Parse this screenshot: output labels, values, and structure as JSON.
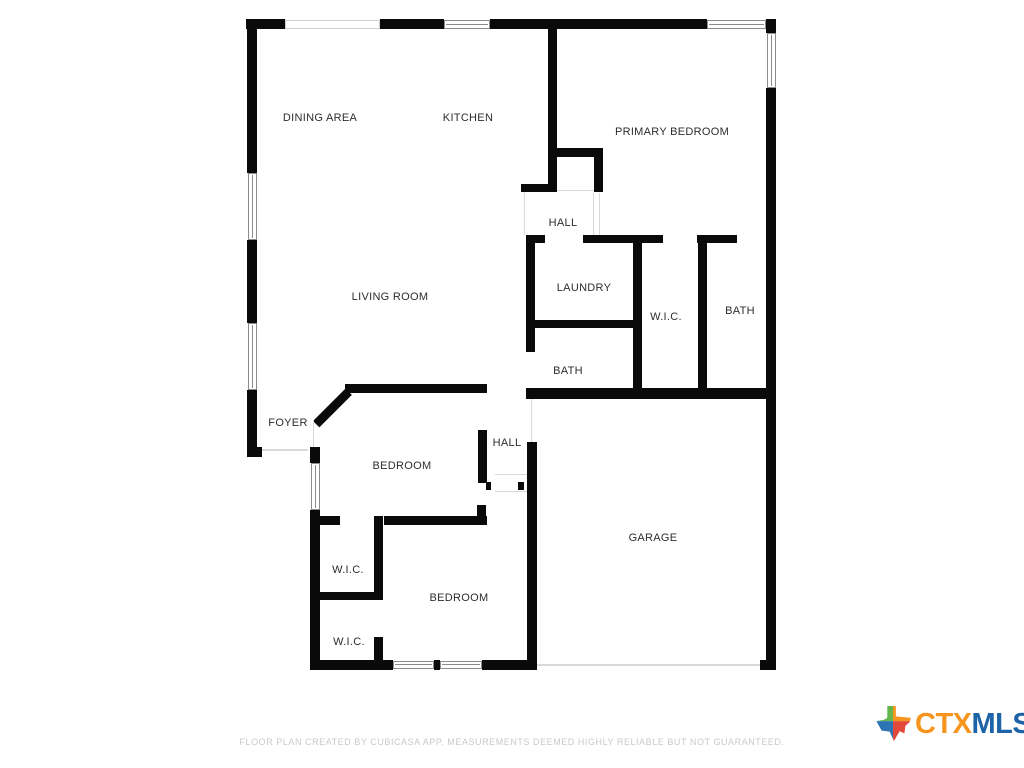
{
  "disclaimer": "FLOOR PLAN CREATED BY CUBICASA APP. MEASUREMENTS DEEMED HIGHLY RELIABLE BUT NOT GUARANTEED.",
  "logo": {
    "ctx": "CTX",
    "mls": "MLS",
    "ctx_color": "#F7941E",
    "mls_color": "#1C63A7",
    "texas_colors": {
      "green": "#64B54C",
      "orange": "#F7941E",
      "blue": "#2D74B5",
      "red": "#E2493B"
    }
  },
  "floorplan": {
    "wall_color": "#0a0a0a",
    "window_border": "#8c8c8c",
    "opening_color": "#d9d9d9",
    "label_color": "#2d2d2d",
    "labels": [
      {
        "id": "dining-area",
        "text": "DINING AREA",
        "x": 320,
        "y": 118
      },
      {
        "id": "kitchen",
        "text": "KITCHEN",
        "x": 468,
        "y": 118
      },
      {
        "id": "primary-bedroom",
        "text": "PRIMARY BEDROOM",
        "x": 672,
        "y": 132
      },
      {
        "id": "hall-upper",
        "text": "HALL",
        "x": 563,
        "y": 223
      },
      {
        "id": "living-room",
        "text": "LIVING ROOM",
        "x": 390,
        "y": 297
      },
      {
        "id": "laundry",
        "text": "LAUNDRY",
        "x": 584,
        "y": 288
      },
      {
        "id": "wic-primary",
        "text": "W.I.C.",
        "x": 666,
        "y": 317
      },
      {
        "id": "bath-primary",
        "text": "BATH",
        "x": 740,
        "y": 311
      },
      {
        "id": "bath-main",
        "text": "BATH",
        "x": 568,
        "y": 371
      },
      {
        "id": "foyer",
        "text": "FOYER",
        "x": 288,
        "y": 423
      },
      {
        "id": "bedroom-front",
        "text": "BEDROOM",
        "x": 402,
        "y": 466
      },
      {
        "id": "hall-lower",
        "text": "HALL",
        "x": 507,
        "y": 443
      },
      {
        "id": "wic-1",
        "text": "W.I.C.",
        "x": 348,
        "y": 570
      },
      {
        "id": "bedroom-lower",
        "text": "BEDROOM",
        "x": 459,
        "y": 598
      },
      {
        "id": "wic-2",
        "text": "W.I.C.",
        "x": 349,
        "y": 642
      },
      {
        "id": "garage",
        "text": "GARAGE",
        "x": 653,
        "y": 538
      }
    ],
    "walls": [
      {
        "x": 246,
        "y": 19,
        "w": 39,
        "h": 10
      },
      {
        "x": 380,
        "y": 19,
        "w": 64,
        "h": 10
      },
      {
        "x": 490,
        "y": 19,
        "w": 217,
        "h": 10
      },
      {
        "x": 766,
        "y": 19,
        "w": 10,
        "h": 14
      },
      {
        "x": 766,
        "y": 88,
        "w": 10,
        "h": 582
      },
      {
        "x": 247,
        "y": 19,
        "w": 10,
        "h": 154
      },
      {
        "x": 247,
        "y": 240,
        "w": 10,
        "h": 83
      },
      {
        "x": 247,
        "y": 390,
        "w": 10,
        "h": 57
      },
      {
        "x": 247,
        "y": 447,
        "w": 15,
        "h": 10
      },
      {
        "x": 548,
        "y": 29,
        "w": 9,
        "h": 163
      },
      {
        "x": 557,
        "y": 148,
        "w": 46,
        "h": 9
      },
      {
        "x": 594,
        "y": 148,
        "w": 9,
        "h": 44
      },
      {
        "x": 521,
        "y": 184,
        "w": 36,
        "h": 8
      },
      {
        "x": 526,
        "y": 235,
        "w": 19,
        "h": 8
      },
      {
        "x": 583,
        "y": 235,
        "w": 80,
        "h": 8
      },
      {
        "x": 697,
        "y": 235,
        "w": 40,
        "h": 8
      },
      {
        "x": 526,
        "y": 243,
        "w": 9,
        "h": 109
      },
      {
        "x": 633,
        "y": 235,
        "w": 9,
        "h": 163
      },
      {
        "x": 698,
        "y": 235,
        "w": 9,
        "h": 163
      },
      {
        "x": 526,
        "y": 320,
        "w": 116,
        "h": 8
      },
      {
        "x": 526,
        "y": 388,
        "w": 250,
        "h": 11
      },
      {
        "x": 527,
        "y": 442,
        "w": 10,
        "h": 228
      },
      {
        "x": 760,
        "y": 660,
        "w": 16,
        "h": 10
      },
      {
        "x": 345,
        "y": 384,
        "w": 142,
        "h": 9
      },
      {
        "x": 478,
        "y": 430,
        "w": 9,
        "h": 53
      },
      {
        "x": 477,
        "y": 505,
        "w": 9,
        "h": 20
      },
      {
        "x": 486,
        "y": 482,
        "w": 5,
        "h": 8
      },
      {
        "x": 518,
        "y": 482,
        "w": 6,
        "h": 8
      },
      {
        "x": 310,
        "y": 516,
        "w": 30,
        "h": 9
      },
      {
        "x": 384,
        "y": 516,
        "w": 103,
        "h": 9
      },
      {
        "x": 310,
        "y": 447,
        "w": 10,
        "h": 16
      },
      {
        "x": 310,
        "y": 510,
        "w": 10,
        "h": 158
      },
      {
        "x": 374,
        "y": 516,
        "w": 9,
        "h": 84
      },
      {
        "x": 374,
        "y": 637,
        "w": 9,
        "h": 31
      },
      {
        "x": 310,
        "y": 592,
        "w": 73,
        "h": 8
      },
      {
        "x": 310,
        "y": 660,
        "w": 83,
        "h": 10
      },
      {
        "x": 434,
        "y": 660,
        "w": 6,
        "h": 10
      },
      {
        "x": 482,
        "y": 660,
        "w": 55,
        "h": 10
      }
    ],
    "diagonals": [
      {
        "x": 313,
        "y": 421,
        "len": 46,
        "thick": 9,
        "angle": -45
      }
    ],
    "windows": [
      {
        "x": 285,
        "y": 20,
        "w": 95,
        "h": 9,
        "variant": "light"
      },
      {
        "x": 444,
        "y": 20,
        "w": 46,
        "h": 9
      },
      {
        "x": 707,
        "y": 20,
        "w": 59,
        "h": 9
      },
      {
        "x": 767,
        "y": 33,
        "w": 9,
        "h": 55
      },
      {
        "x": 248,
        "y": 173,
        "w": 9,
        "h": 67
      },
      {
        "x": 248,
        "y": 323,
        "w": 9,
        "h": 67
      },
      {
        "x": 311,
        "y": 463,
        "w": 9,
        "h": 47
      },
      {
        "x": 393,
        "y": 661,
        "w": 41,
        "h": 8
      },
      {
        "x": 440,
        "y": 661,
        "w": 42,
        "h": 8
      }
    ],
    "openings": [
      {
        "x": 262,
        "y": 449,
        "w": 46,
        "h": 2
      },
      {
        "x": 537,
        "y": 664,
        "w": 223,
        "h": 2
      },
      {
        "x": 557,
        "y": 190,
        "w": 37,
        "h": 1
      },
      {
        "x": 593,
        "y": 193,
        "w": 1,
        "h": 42
      },
      {
        "x": 599,
        "y": 193,
        "w": 1,
        "h": 42
      },
      {
        "x": 524,
        "y": 192,
        "w": 1,
        "h": 43
      },
      {
        "x": 531,
        "y": 399,
        "w": 1,
        "h": 43
      },
      {
        "x": 313,
        "y": 420,
        "w": 1,
        "h": 27
      },
      {
        "x": 495,
        "y": 474,
        "w": 32,
        "h": 1
      },
      {
        "x": 495,
        "y": 491,
        "w": 32,
        "h": 1
      }
    ]
  }
}
